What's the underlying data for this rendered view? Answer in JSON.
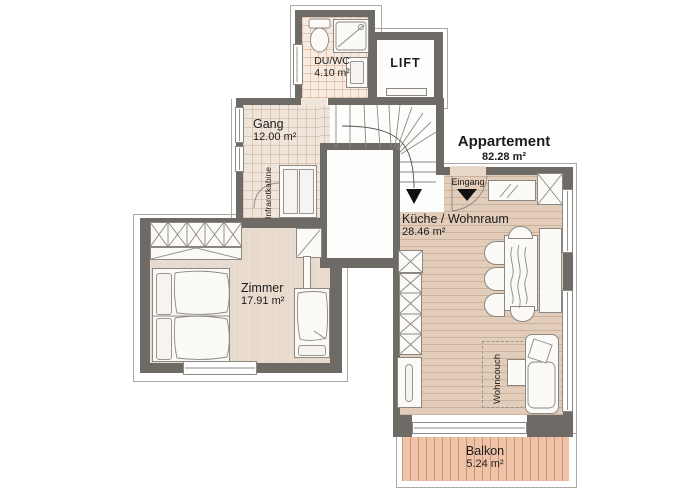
{
  "title": {
    "name": "Appartement",
    "area": "82.28 m²"
  },
  "rooms": {
    "duwc": {
      "name": "DU/WC",
      "area": "4.10 m²"
    },
    "lift": {
      "name": "LIFT"
    },
    "gang": {
      "name": "Gang",
      "area": "12.00 m²"
    },
    "zimmer": {
      "name": "Zimmer",
      "area": "17.91 m²"
    },
    "kueche": {
      "name": "Küche / Wohnraum",
      "area": "28.46 m²"
    },
    "balkon": {
      "name": "Balkon",
      "area": "5.24 m²"
    }
  },
  "annotations": {
    "infrarotkabine": "Infrarotkabine",
    "eingang": "Eingang",
    "wohncouch": "Wohncouch"
  },
  "colors": {
    "wall": "#6e6b67",
    "bath_tile": "#f8eade",
    "hall_tile": "#f0e5da",
    "living_floor": "#e2cdba",
    "bedroom_floor": "#e8dacd",
    "balcony_deck": "#eec3a7",
    "furniture": "#fbfaf7",
    "line": "#8b8884",
    "text": "#1c1c1c"
  }
}
